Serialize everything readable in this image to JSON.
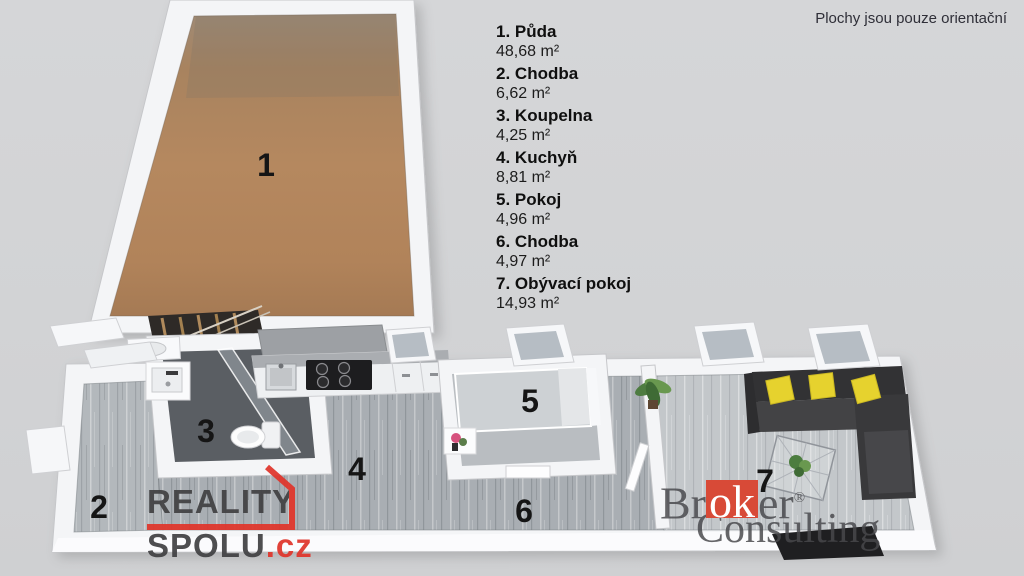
{
  "disclaimer": "Plochy jsou pouze orientační",
  "legend": {
    "items": [
      {
        "number": "1.",
        "name": "Půda",
        "area": "48,68 m²"
      },
      {
        "number": "2.",
        "name": "Chodba",
        "area": "6,62 m²"
      },
      {
        "number": "3.",
        "name": "Koupelna",
        "area": "4,25 m²"
      },
      {
        "number": "4.",
        "name": "Kuchyň",
        "area": "8,81 m²"
      },
      {
        "number": "5.",
        "name": "Pokoj",
        "area": "4,96 m²"
      },
      {
        "number": "6.",
        "name": "Chodba",
        "area": "4,97 m²"
      },
      {
        "number": "7.",
        "name": "Obývací pokoj",
        "area": "14,93 m²"
      }
    ]
  },
  "plan": {
    "room_numbers": [
      "1",
      "2",
      "3",
      "4",
      "5",
      "6",
      "7"
    ]
  },
  "watermarks": {
    "reality_spolu": {
      "line1": "REALITY",
      "line2": "SPOLU",
      "tld": ".cz"
    },
    "broker": {
      "part1": "Br",
      "highlight": "ok",
      "part2": "er",
      "registered": "®",
      "line2": "Consulting"
    }
  },
  "colors": {
    "accent_red": "#e0352b",
    "broker_red": "#d84a37",
    "attic_floor": "#b1855e",
    "hall_floor": "#a9aeb3",
    "entry_floor": "#b3b8bc",
    "living_floor": "#c3c7ca",
    "bathroom_floor": "#5a5e63",
    "sofa_dark": "#323234",
    "pillow_yellow": "#e6d22e",
    "wall_white": "#f4f5f7",
    "background": "#d3d4d6"
  }
}
